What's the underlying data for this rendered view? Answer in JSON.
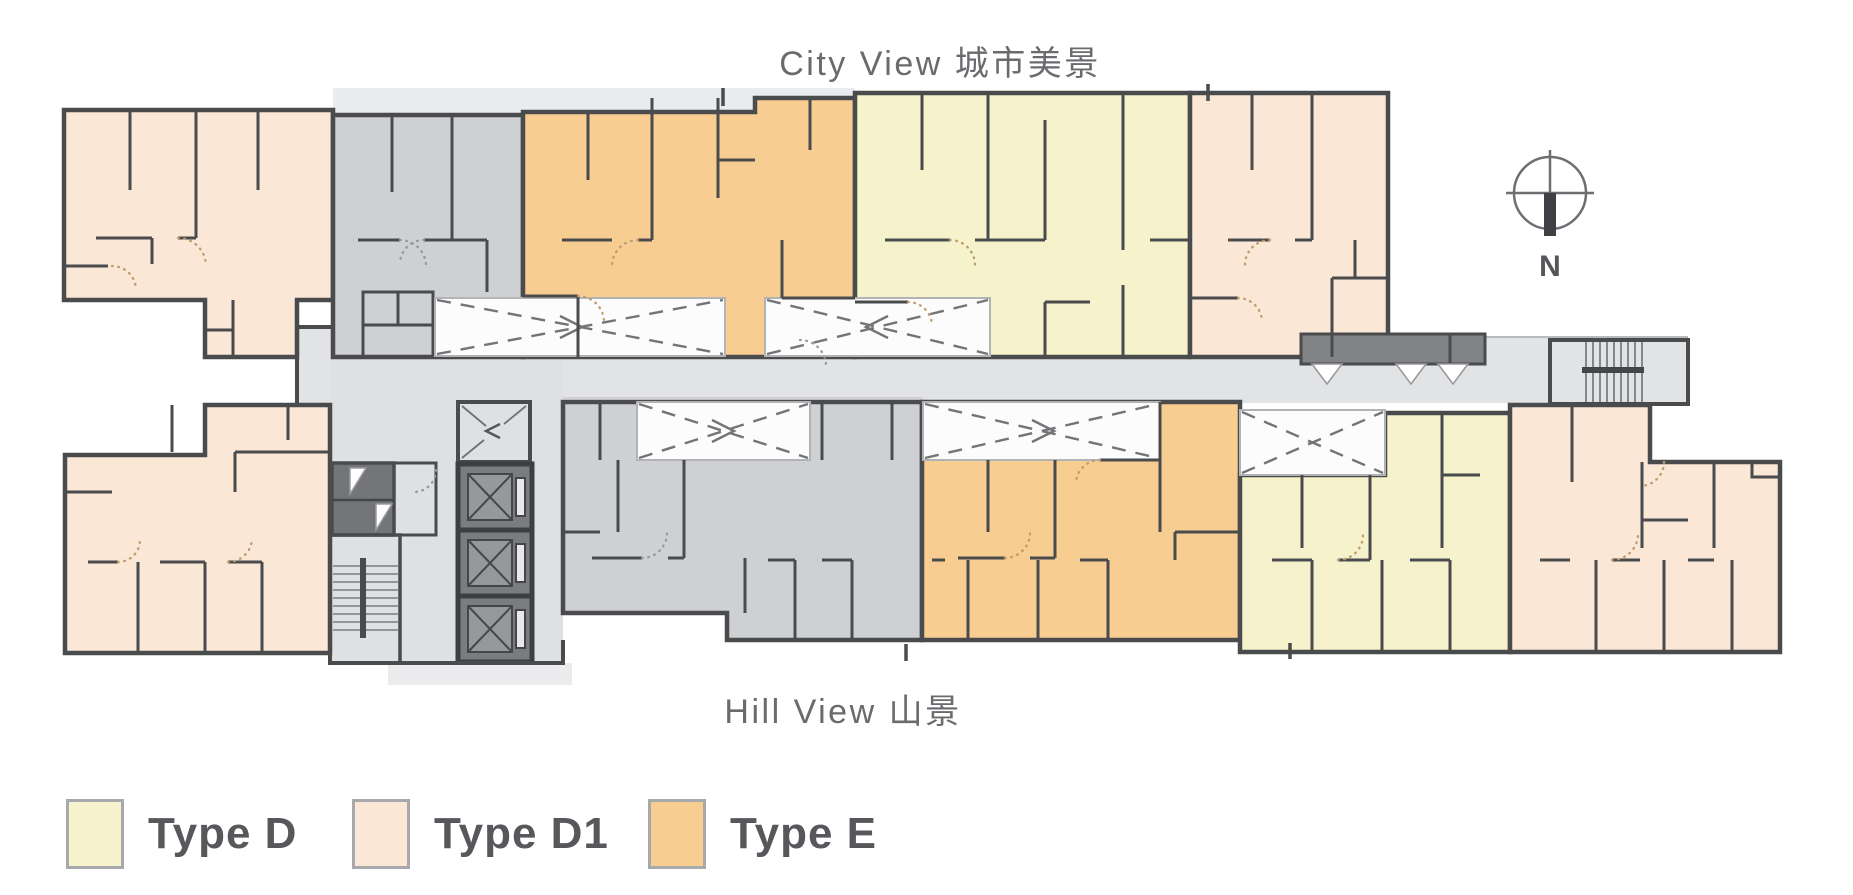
{
  "labels": {
    "city_view": "City View 城市美景",
    "hill_view": "Hill View 山景"
  },
  "compass": {
    "label": "N"
  },
  "legend": {
    "items": [
      {
        "label": "Type D",
        "color": "#f6f2cb"
      },
      {
        "label": "Type D1",
        "color": "#fbe7d6"
      },
      {
        "label": "Type E",
        "color": "#f8cd92"
      }
    ]
  },
  "colors": {
    "wall": "#4a4b4d",
    "type-d": "#f6f2cb",
    "type-d1": "#fbe7d6",
    "type-e": "#f8cd92",
    "common-gray": "#cfd0d3",
    "lobby": "#dfe0e2",
    "corridor": "#e2e3e5",
    "dark-room": "#747578",
    "ledge": "#eaebec",
    "text-gray": "#6a6b6e",
    "legend-text": "#57585b"
  }
}
